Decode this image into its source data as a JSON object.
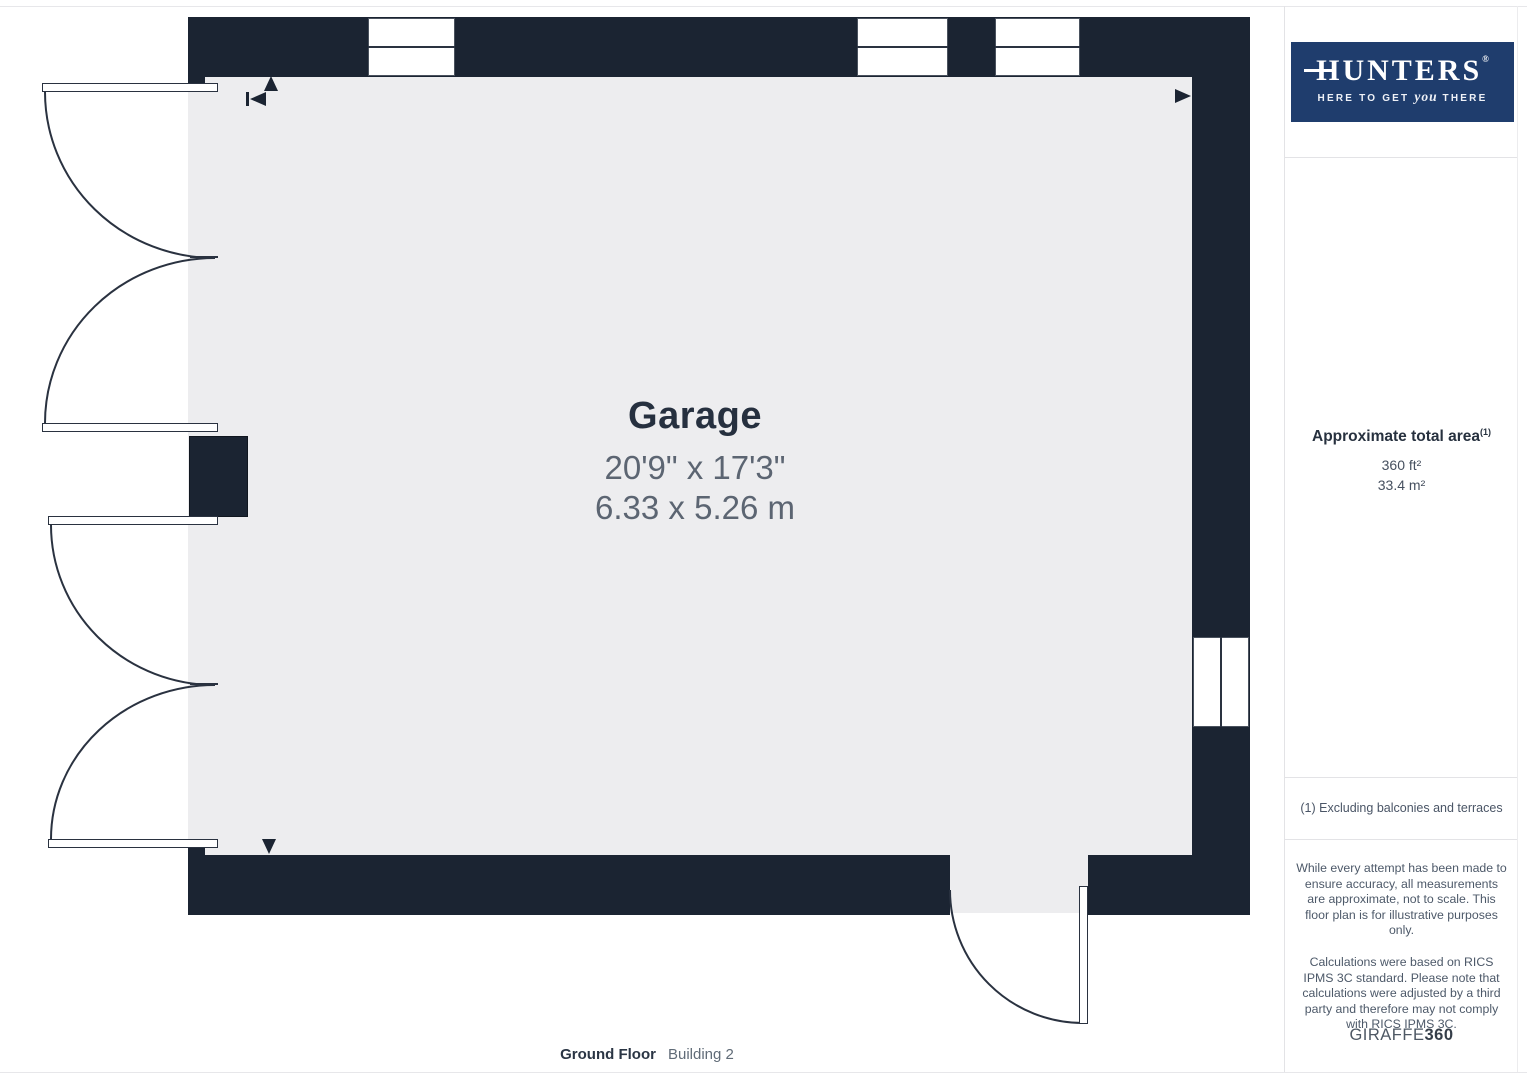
{
  "room": {
    "name": "Garage",
    "dimensions_imperial": "20'9\" x 17'3\"",
    "dimensions_metric": "6.33 x 5.26 m"
  },
  "floor_label": {
    "primary": "Ground Floor",
    "secondary": "Building 2"
  },
  "sidebar": {
    "logo": {
      "brand": "HUNTERS",
      "registered": "®",
      "tagline_prefix": "HERE TO GET ",
      "tagline_emphasis": "you",
      "tagline_suffix": " THERE"
    },
    "area": {
      "title": "Approximate total area",
      "footnote_marker": "(1)",
      "imperial": "360 ft²",
      "metric": "33.4 m²"
    },
    "footnote": "(1) Excluding balconies and terraces",
    "disclaimer_1": "While every attempt has been made to ensure accuracy, all measurements are approximate, not to scale. This floor plan is for illustrative purposes only.",
    "disclaimer_2": "Calculations were based on RICS IPMS 3C standard. Please note that calculations were adjusted by a third party and therefore may not comply with RICS IPMS 3C.",
    "brand_footer_name": "GIRAFFE",
    "brand_footer_suffix": "360"
  },
  "colors": {
    "wall": "#1b2432",
    "floor": "#ededef",
    "logo_background": "#1f3d6d",
    "title_text": "#26303f",
    "dimension_text": "#5c6572"
  }
}
